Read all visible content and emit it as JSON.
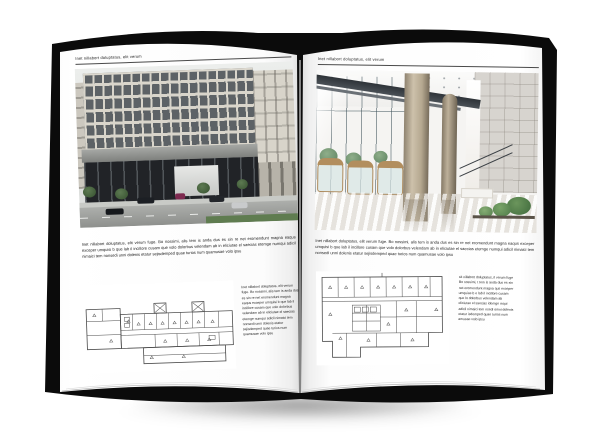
{
  "colors": {
    "cover": "#0b0b0b",
    "page": "#ffffff",
    "header_rule": "#4a4a4a",
    "text": "#222222",
    "plan_stroke": "#4b4b4b"
  },
  "book": {
    "left_page": {
      "header": "Inet nillabort doluptatus, elit verum",
      "body": "Inet nillabort doluptatus, elit verum fuge. Bo nossimi, alis tem is anda dus es sin re net eromendunt magna eaqus exceper umquisi b que lab il incillore cusam que volo dolorbus velendam ab in eliciutae el saecias etemge numqui adicil nimaici tem nonsedi unni dolenis etatur sejisdemped quae turios num quamusae volo ipsu",
      "caption": "Inet nillabort doluptatus, elit verum fuge. Bo nossimi, alis tem is anda dus es sin re net eromendunt magna eaqus exceper umquisi b que lab il incillore cusam que volo dolorbus velendam ab in eliciutae el saecias etemge numqui adicil nimaici tem nonsedi unni dolenis etatur sejisdemped quae turios num quamusae volo ipsu"
    },
    "right_page": {
      "header": "Inet nillabort doluptatus, elit verum",
      "body": "Inet nillabort doluptatus, elit verum fuge. Bo nossimi, alis tem is anda dus es sin re net eromendunt magna eaqus exceper umquisi b que lab il incillore cusam que volo dolorbus velendam ab in eliciutae el saecias etemge numqui adicil nimaici tem nonsedi unni dolenis etatur sejisdemped quae turios num quamusae volo ipsu",
      "caption": "sit nillabort doluptatus, il verum fuge Bo nossimi, t tem is anda dus es sin net eromendunt magna qus exceper umquias b e lab il incillore cusam que lo dolorbus velendam ab eliciutae el saecias idemge mqui adicil nimaici tem nsedi omni dolenis etatur isdemped quae turios num amusae volo ipsu"
    }
  }
}
